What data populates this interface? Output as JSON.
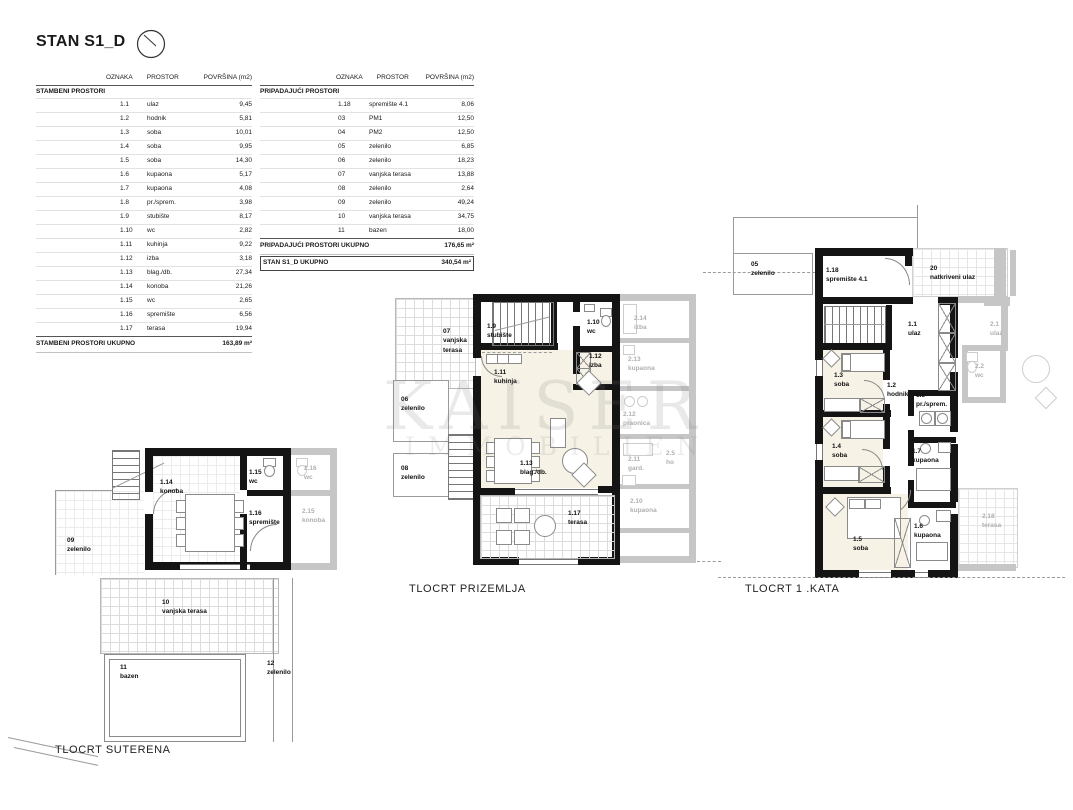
{
  "header": {
    "title": "STAN S1_D",
    "icon": "north-arrow"
  },
  "colors": {
    "wall": "#141414",
    "neighbor_gray": "#c6c6c6",
    "room_fill": "#f6f2e6",
    "grid_line": "#dcdcdc"
  },
  "tables": {
    "headers": {
      "oznaka": "OZNAKA",
      "prostor": "PROSTOR",
      "povrsina": "POVRŠINA (m2)"
    },
    "left": {
      "section": "STAMBENI PROSTORI",
      "rows": [
        [
          "1.1",
          "ulaz",
          "9,45"
        ],
        [
          "1.2",
          "hodnik",
          "5,81"
        ],
        [
          "1.3",
          "soba",
          "10,01"
        ],
        [
          "1.4",
          "soba",
          "9,95"
        ],
        [
          "1.5",
          "soba",
          "14,30"
        ],
        [
          "1.6",
          "kupaona",
          "5,17"
        ],
        [
          "1.7",
          "kupaona",
          "4,08"
        ],
        [
          "1.8",
          "pr./sprem.",
          "3,98"
        ],
        [
          "1.9",
          "stubište",
          "8,17"
        ],
        [
          "1.10",
          "wc",
          "2,82"
        ],
        [
          "1.11",
          "kuhinja",
          "9,22"
        ],
        [
          "1.12",
          "izba",
          "3,18"
        ],
        [
          "1.13",
          "blag./db.",
          "27,34"
        ],
        [
          "1.14",
          "konoba",
          "21,26"
        ],
        [
          "1.15",
          "wc",
          "2,65"
        ],
        [
          "1.16",
          "spremište",
          "6,56"
        ],
        [
          "1.17",
          "terasa",
          "19,94"
        ]
      ],
      "total_label": "STAMBENI PROSTORI UKUPNO",
      "total_value": "163,89 m²"
    },
    "right": {
      "section": "PRIPADAJUĆI PROSTORI",
      "rows": [
        [
          "1.18",
          "spremište 4.1",
          "8,06"
        ],
        [
          "03",
          "PM1",
          "12,50"
        ],
        [
          "04",
          "PM2",
          "12,50"
        ],
        [
          "05",
          "zelenilo",
          "6,85"
        ],
        [
          "06",
          "zelenilo",
          "18,23"
        ],
        [
          "07",
          "vanjska terasa",
          "13,88"
        ],
        [
          "08",
          "zelenilo",
          "2,64"
        ],
        [
          "09",
          "zelenilo",
          "49,24"
        ],
        [
          "10",
          "vanjska terasa",
          "34,75"
        ],
        [
          "11",
          "bazen",
          "18,00"
        ]
      ],
      "total_label": "PRIPADAJUĆI PROSTORI UKUPNO",
      "total_value": "176,65 m²",
      "grand_label": "STAN S1_D UKUPNO",
      "grand_value": "340,54 m²"
    }
  },
  "plans": {
    "suterena": {
      "caption": "TLOCRT SUTERENA",
      "rooms": [
        {
          "num": "1.14",
          "name": "konoba"
        },
        {
          "num": "1.15",
          "name": "wc"
        },
        {
          "num": "1.16",
          "name": "spremište"
        },
        {
          "num": "09",
          "name": "zelenilo"
        },
        {
          "num": "10",
          "name": "vanjska terasa"
        },
        {
          "num": "11",
          "name": "bazen"
        },
        {
          "num": "12",
          "name": "zelenilo"
        },
        {
          "num": "2.16",
          "name": "wc"
        },
        {
          "num": "2.15",
          "name": "konoba"
        }
      ]
    },
    "prizemlje": {
      "caption": "TLOCRT PRIZEMLJA",
      "rooms": [
        {
          "num": "07",
          "name": "vanjska terasa"
        },
        {
          "num": "1.9",
          "name": "stubište"
        },
        {
          "num": "1.10",
          "name": "wc"
        },
        {
          "num": "1.12",
          "name": "izba"
        },
        {
          "num": "1.11",
          "name": "kuhinja"
        },
        {
          "num": "06",
          "name": "zelenilo"
        },
        {
          "num": "08",
          "name": "zelenilo"
        },
        {
          "num": "1.13",
          "name": "blag./db."
        },
        {
          "num": "1.17",
          "name": "terasa"
        },
        {
          "num": "2.14",
          "name": "izba"
        },
        {
          "num": "2.13",
          "name": "kupaona"
        },
        {
          "num": "2.12",
          "name": "praonica"
        },
        {
          "num": "2.11",
          "name": "gard."
        },
        {
          "num": "2.5",
          "name": "ho"
        },
        {
          "num": "2.10",
          "name": "kupaona"
        }
      ]
    },
    "kat1": {
      "caption": "TLOCRT 1 .KATA",
      "rooms": [
        {
          "num": "05",
          "name": "zelenilo"
        },
        {
          "num": "1.18",
          "name": "spremište 4.1"
        },
        {
          "num": "20",
          "name": "natkriveni ulaz"
        },
        {
          "num": "1.1",
          "name": "ulaz"
        },
        {
          "num": "1.3",
          "name": "soba"
        },
        {
          "num": "1.2",
          "name": "hodnik"
        },
        {
          "num": "1.8",
          "name": "pr./sprem."
        },
        {
          "num": "1.4",
          "name": "soba"
        },
        {
          "num": "1.7",
          "name": "kupaona"
        },
        {
          "num": "1.5",
          "name": "soba"
        },
        {
          "num": "1.6",
          "name": "kupaona"
        },
        {
          "num": "2.1",
          "name": "ulaz"
        },
        {
          "num": "2.2",
          "name": "wc"
        },
        {
          "num": "2.18",
          "name": "terasa"
        }
      ]
    }
  },
  "watermark": {
    "line1": "KAISER",
    "line2": "IMMOBILIEN"
  }
}
